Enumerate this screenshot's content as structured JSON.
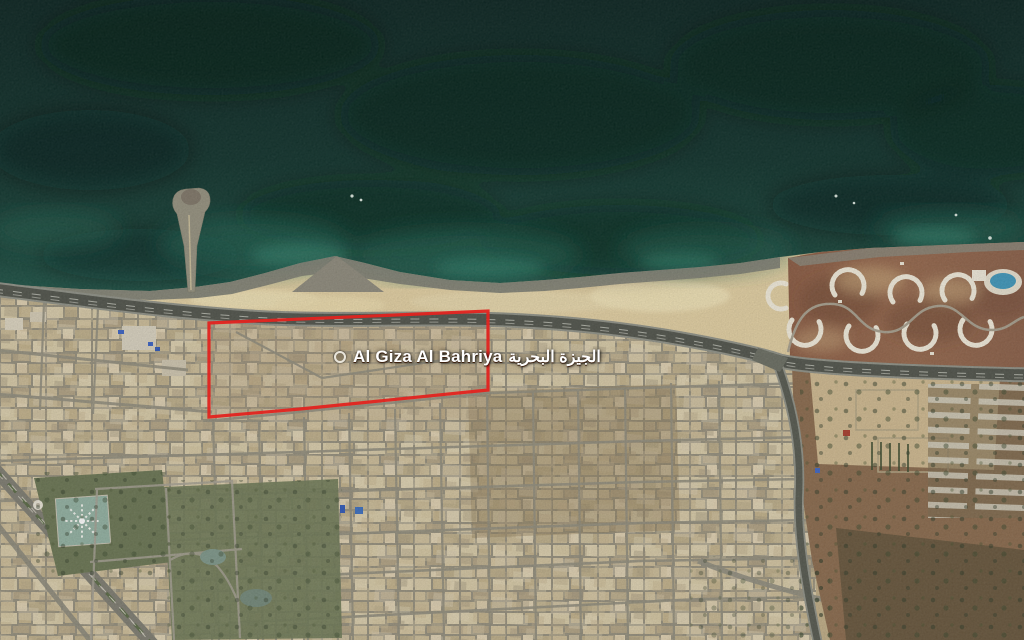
{
  "map": {
    "view_type": "satellite",
    "place_label": {
      "latin": "Al Giza Al Bahriya",
      "arabic": "الجيزة البحرية"
    },
    "marker": {
      "kind": "place-ring-marker",
      "color": "#e9e5da"
    },
    "region_overlay": {
      "points": "209,323 488,311 488,390 300,409 209,417",
      "color": "#e32420",
      "stroke_width": "3.2"
    },
    "palette": {
      "sea_deep": "#0a2320",
      "sea_mid": "#0f312b",
      "sea_shallow": "#1d5246",
      "sea_bright": "#2d7a66",
      "shore_rock": "#7e8074",
      "sand": "#e2cfa2",
      "sand_bright": "#f0e2b6",
      "urban_ground": "#b3a07d",
      "building_light": "#ddd0af",
      "street_grey": "#918d7d",
      "asphalt_dark": "#50534b",
      "park_green": "#6a7553",
      "pool_teal": "#92b1a2",
      "resort_ground": "#95674c",
      "resort_building": "#f2ecdc",
      "field_brown": "#8a6a4d",
      "tree_green": "#2e3a27",
      "label_white": "#ffffff"
    }
  }
}
